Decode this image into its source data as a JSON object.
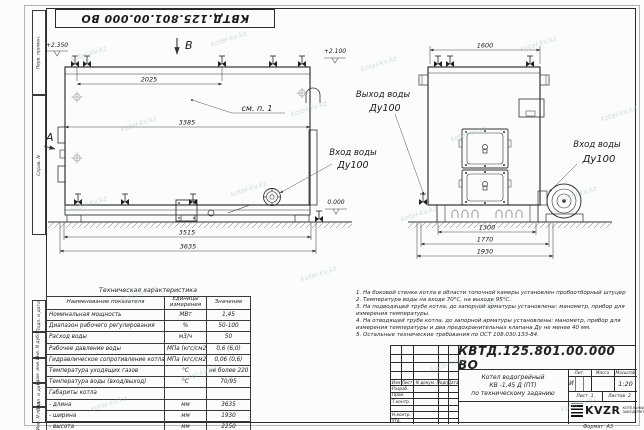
{
  "sheet": {
    "watermark": "kotel-kv.kz",
    "format_label": "Формат",
    "format_value": "А3"
  },
  "frame_labels": {
    "perv_primen": "Перв. примен.",
    "sprav_n": "Справ. N",
    "podp_data1": "Подп. и дата",
    "inv_dubl": "Инв. N дубл.",
    "vzam_inv": "Взам. инв. N",
    "podp_data2": "Подп. и дата",
    "inv_podl": "Инв. N подл."
  },
  "side_view": {
    "view_label": "В",
    "section_label": "А",
    "elevation_top": "+2.350",
    "elevation_mid": "+2.100",
    "elevation_zero": "0.000",
    "note_ref": "см. п. 1",
    "dims": {
      "top": "2025",
      "body": "3385",
      "base": "3515",
      "overall": "3635"
    },
    "inlet": {
      "line1": "Вход воды",
      "line2": "Ду100"
    }
  },
  "front_view": {
    "dims": {
      "top": "1600",
      "base": "1300",
      "mid": "1770",
      "overall": "1930"
    },
    "outlet": {
      "line1": "Выход воды",
      "line2": "Ду100"
    },
    "inlet": {
      "line1": "Вход воды",
      "line2": "Ду100"
    }
  },
  "tech_table": {
    "title": "Техническая характеристика",
    "headers": [
      "Наименование показателя",
      "Единицы измерения",
      "Значение"
    ],
    "rows": [
      {
        "name": "Номинальная мощность",
        "unit": "МВт",
        "value": "1,45"
      },
      {
        "name": "Диапазон рабочего регулирования",
        "unit": "%",
        "value": "50-100"
      },
      {
        "name": "Расход воды",
        "unit": "м3/ч",
        "value": "50"
      },
      {
        "name": "Рабочее давление воды",
        "unit": "МПа (кгс/см2)",
        "value": "0,6 (6,0)"
      },
      {
        "name": "Гидравлическое сопротивление котла",
        "unit": "МПа (кгс/см2)",
        "value": "0,06 (0,6)"
      },
      {
        "name": "Температура уходящих газов",
        "unit": "°С",
        "value": "не более 220"
      },
      {
        "name": "Температура воды (вход/выход)",
        "unit": "°С",
        "value": "70/95"
      },
      {
        "name": "Габариты котла",
        "unit": "",
        "value": ""
      },
      {
        "name": "- длина",
        "unit": "мм",
        "value": "3635"
      },
      {
        "name": "- ширина",
        "unit": "мм",
        "value": "1930"
      },
      {
        "name": "- высота",
        "unit": "мм",
        "value": "2250"
      }
    ]
  },
  "notes": {
    "items": [
      "1.  На боковой стенке котла в области топочной камеры установлен пробоотборный штуцер",
      "2.  Температура воды на входе 70°С, на выходе 95°С.",
      "3.  На подводящей трубе котла, до запорной арматуры установлены: манометр, прибор для измерения температуры.",
      "4.  На отводящей трубе котла, до запорной арматуры установлены: манометр, прибор для измерения температуры и два предохранительных клапана  Ду не менее  40 мм.",
      "5.  Остальные технические требования по ОСТ 108.030.133-84."
    ]
  },
  "title_block": {
    "doc_number": "КВТД.125.801.00.000  ВО",
    "title_line1": "Котел водогрейный",
    "title_line2": "КВ -1,45 Д (ПТ)",
    "title_line3": "по техническому заданию",
    "change_headers": [
      "Изм",
      "Лист",
      "N докум.",
      "Подп.",
      "Дата"
    ],
    "sign_rows": [
      "Разраб.",
      "Пров.",
      "Т.контр.",
      "",
      "Н.контр.",
      "Утв."
    ],
    "lit_header": "Лит.",
    "mass_header": "Масса",
    "scale_header": "Масштаб",
    "lit_value": "И",
    "scale_value": "1:20",
    "sheet_label": "Лист",
    "sheet_value": "1",
    "sheets_label": "Листов",
    "sheets_value": "2",
    "logo_text": "KVZR",
    "logo_sub1": "КОТЕЛЬНЫЙ",
    "logo_sub2": "ЗАВОД РЭП"
  }
}
